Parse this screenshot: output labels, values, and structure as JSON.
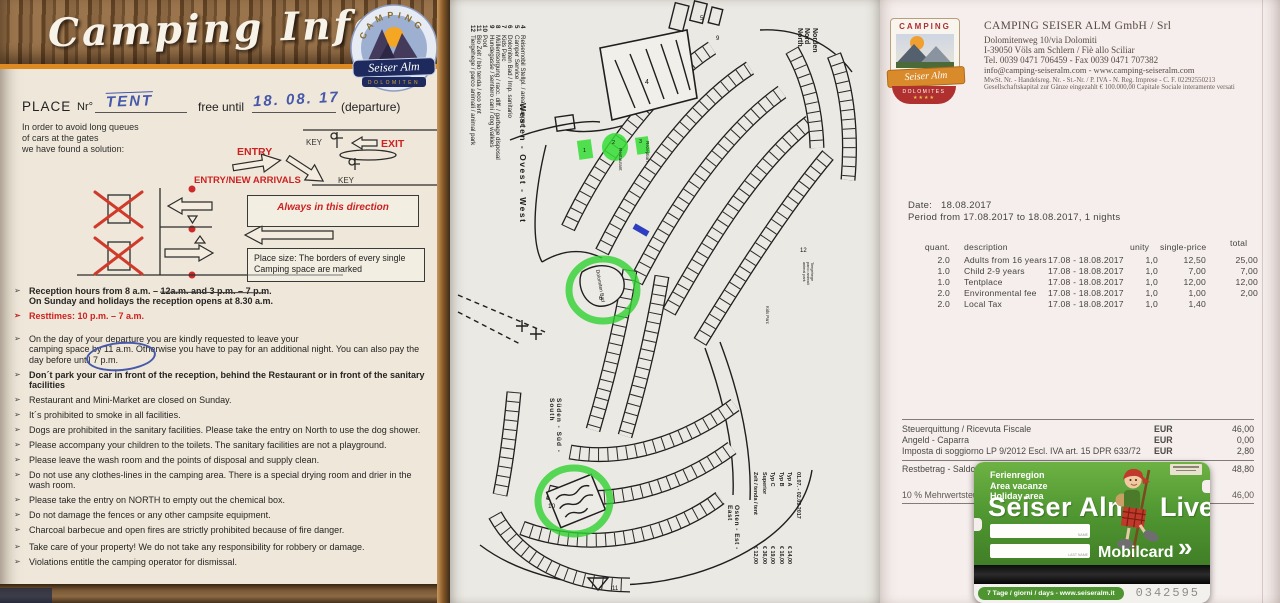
{
  "colors": {
    "accent_red": "#cc2222",
    "ink_blue": "#4558aa",
    "marker_green": "#35de35",
    "card_green": "#4e9430"
  },
  "info_sheet": {
    "title": "Camping Info",
    "logo": {
      "arc_text": "CAMPING",
      "name": "Seiser Alm",
      "subtitle": "DOLOMITEN"
    },
    "place_row": {
      "place_label": "PLACE",
      "nr_label": "Nr°",
      "place_value": "TENT",
      "free_until_label": "free until",
      "date_value": "18. 08. 17",
      "departure_label": "(departure)"
    },
    "intro": "In order to avoid long queues\nof cars at the gates\nwe have found a solution:",
    "diagram": {
      "entry_label": "ENTRY",
      "exit_label": "EXIT",
      "entry_new_label": "ENTRY/NEW ARRIVALS",
      "key_label_1": "KEY",
      "key_label_2": "KEY",
      "direction_note": "Always in this direction",
      "place_size_note": "Place size: The borders of every single\nCamping space are marked"
    },
    "rules_marker": "➢",
    "rules": [
      {
        "cls": "b",
        "text": "Reception hours from 8 a.m. – 12a.m. and 3 p.m. – 7 p.m.\nOn Sunday and holidays the reception opens at 8.30 a.m."
      },
      {
        "cls": "r",
        "text": "Resttimes: 10 p.m. – 7 a.m."
      },
      {
        "cls": "gap",
        "text": "On the day of your departure you are kindly requested to leave your\ncamping space by 11 a.m. Otherwise you have to pay for an additional night. You can also pay the day before until 7 p.m."
      },
      {
        "cls": "b",
        "text": "Don´t park your car in front of the reception, behind the Restaurant or in front of the sanitary facilities"
      },
      {
        "cls": "",
        "text": "Restaurant and Mini-Market are closed on Sunday."
      },
      {
        "cls": "",
        "text": "It´s prohibited to smoke in all facilities."
      },
      {
        "cls": "",
        "text": "Dogs are prohibited in the sanitary facilities. Please take the entry on North to use the dog shower."
      },
      {
        "cls": "",
        "text": "Please accompany your children to the toilets. The sanitary facilities are not a playground."
      },
      {
        "cls": "",
        "text": "Please leave the wash room and the points of disposal and supply clean."
      },
      {
        "cls": "",
        "text": "Do not use any clothes-lines in the camping area. There is a special drying room and drier in the wash room."
      },
      {
        "cls": "",
        "text": "Please take the entry on NORTH to empty out the chemical box."
      },
      {
        "cls": "",
        "text": "Do not damage the fences or any other campsite equipment."
      },
      {
        "cls": "",
        "text": "Charcoal barbecue and open fires are strictly prohibited because of fire danger."
      },
      {
        "cls": "gap",
        "text": "Take care of your property! We do not take any responsibility for robbery or damage."
      },
      {
        "cls": "",
        "text": "Violations entitle the camping operator for dismissal."
      }
    ]
  },
  "site_map": {
    "legend": [
      {
        "num": "4",
        "label": "Reisemobil Stellpl. / area camper"
      },
      {
        "num": "5",
        "label": "Camper Service"
      },
      {
        "num": "6",
        "label": "Dolomiten Bad / Imp. sanitario"
      },
      {
        "num": "7",
        "label": "Kids Parc"
      },
      {
        "num": "8",
        "label": "Müllentsorgung / racc. diff. / garbage disposal"
      },
      {
        "num": "9",
        "label": "Hundegasse / sentiero cani / dog walkies"
      },
      {
        "num": "10",
        "label": "Pool"
      },
      {
        "num": "11",
        "label": "Bio Zelt / bio tenda / eco tent"
      },
      {
        "num": "12",
        "label": "Tiergehege / parco animali / animal park"
      }
    ],
    "compass": {
      "north": "Norden\nNord\nNorth",
      "west": "Westen - Ovest - West",
      "south": "Süden - Süd - South",
      "east": "Osten - Est - East"
    },
    "side_labels": {
      "animal_park": "Tiergehege\nparco animali\nanimal park",
      "kids": "Kids Parc"
    },
    "markers": {
      "m1": "1",
      "m2": "2",
      "m3": "3",
      "m4": "4",
      "m5": "5",
      "m6": "6",
      "m9": "9",
      "m10": "10",
      "m11": "11",
      "m12": "12"
    },
    "highlight_labels": {
      "restaurant": "Restaurant",
      "reception": "Rezeption",
      "bath": "Dolomiten Bad"
    },
    "season_dates": "01.07. - 02.09.2017",
    "price_list": [
      {
        "label": "Typ A",
        "price": "€ 14,00"
      },
      {
        "label": "Typ B",
        "price": "€ 16,00"
      },
      {
        "label": "Typ C",
        "price": "€ 19,00"
      },
      {
        "label": "Superior",
        "price": "€ 36,00"
      },
      {
        "label": "Zelt / tenda / tent",
        "price": "€ 12,00"
      }
    ],
    "plot_numbers_observed": "101-112, 121-133, 201-221, 251-254, 261-265, 301-321, 323-324, 401-435, 601-609, 701-709, 801-816, 901-918, 169-179 (site categories A / B / C)"
  },
  "receipt": {
    "company": {
      "name": "CAMPING SEISER ALM GmbH / Srl",
      "address1": "Dolomitenweg 10/via Dolomiti",
      "address2": "I-39050 Völs am Schlern / Fiè allo Sciliar",
      "phone": "Tel. 0039 0471 706459 - Fax 0039 0471 707382",
      "web": "info@camping-seiseralm.com - www.camping-seiseralm.com",
      "reg": "MwSt. Nr. - Handelsreg. Nr. - St.-Nr. / P. IVA - N. Reg. Imprese - C. F. 02292550213",
      "capital": "Gesellschaftskapital zur Gänze eingezahlt € 100.000,00 Capitale Sociale interamente versati"
    },
    "logo": {
      "top": "CAMPING",
      "name": "Seiser Alm",
      "bottom": "DOLOMITES",
      "stars": "★★★★"
    },
    "date_label": "Date:",
    "date_value": "18.08.2017",
    "period_line": "Period from 17.08.2017 to 18.08.2017, 1 nights",
    "table": {
      "headers": {
        "quant": "quant.",
        "description": "description",
        "unity": "unity",
        "single_price": "single-price",
        "total": "total"
      },
      "rows": [
        {
          "quant": "2.0",
          "description": "Adults from 16 years",
          "period": "17.08 - 18.08.2017",
          "unity": "1,0",
          "price": "12,50",
          "total": "25,00"
        },
        {
          "quant": "1.0",
          "description": "Child 2-9 years",
          "period": "17.08 - 18.08.2017",
          "unity": "1,0",
          "price": "7,00",
          "total": "7,00"
        },
        {
          "quant": "1.0",
          "description": "Tentplace",
          "period": "17.08 - 18.08.2017",
          "unity": "1,0",
          "price": "12,00",
          "total": "12,00"
        },
        {
          "quant": "2.0",
          "description": "Environmental fee",
          "period": "17.08 - 18.08.2017",
          "unity": "1,0",
          "price": "1,00",
          "total": "2,00"
        },
        {
          "quant": "2.0",
          "description": "Local Tax",
          "period": "17.08 - 18.08.2017",
          "unity": "1,0",
          "price": "1,40",
          "total": ""
        }
      ]
    },
    "summary": [
      {
        "cls": "",
        "label": "Steuerquittung / Ricevuta Fiscale",
        "cur": "EUR",
        "amt": "46,00"
      },
      {
        "cls": "",
        "label": "Angeld - Caparra",
        "cur": "EUR",
        "amt": "0,00"
      },
      {
        "cls": "",
        "label": "Imposta di soggiorno LP 9/2012 Escl. IVA art. 15 DPR 633/72",
        "cur": "EUR",
        "amt": "2,80"
      },
      {
        "cls": "strong",
        "label": "Restbetrag - Saldo da pagare",
        "cur": "EUR",
        "amt": "48,80"
      },
      {
        "cls": "vat",
        "label": "10 % Mehrwertsteuer",
        "cur": "EUR",
        "amt": "46,00"
      }
    ]
  },
  "mobilcard": {
    "region_lines": "Ferienregion\nArea vacanze\nHoliday area",
    "title": "Seiser Alm",
    "title_right": "Live",
    "brand": "Mobilcard",
    "chevrons": "»",
    "name_label": "NAME",
    "lastname_label": "LAST NAME",
    "validity": "7 Tage / giorni / days - www.seiseralm.it",
    "serial": "0342595"
  }
}
